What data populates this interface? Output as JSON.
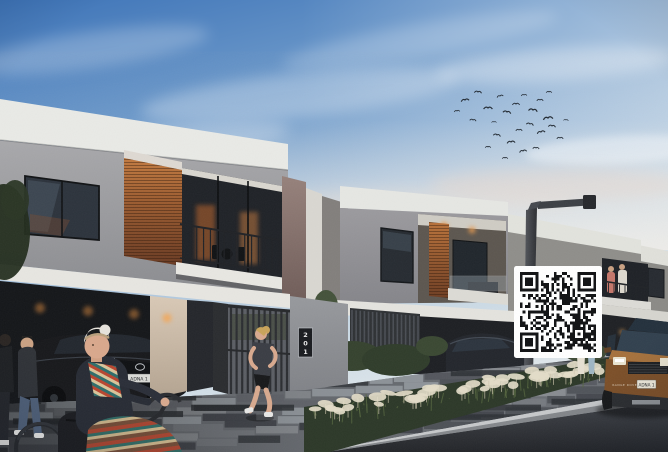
{
  "scene": {
    "kind": "dusk architectural rendering of modern two-storey townhouses",
    "house_number": "201",
    "lexus_plate": "ADNA 1",
    "suv_plate": "ADNA 1",
    "suv_hood_text": "RANGE ROVER"
  },
  "qr": {
    "modules": 29,
    "seed": 73512,
    "dark": "#101113",
    "light": "#ffffff",
    "x": 514,
    "y": 266,
    "w": 88,
    "h": 92,
    "quiet": 6
  },
  "birds": [
    [
      465,
      100,
      1.0,
      -10
    ],
    [
      478,
      92,
      0.9,
      5
    ],
    [
      488,
      108,
      1.1,
      0
    ],
    [
      500,
      96,
      0.8,
      -15
    ],
    [
      507,
      112,
      1.0,
      10
    ],
    [
      516,
      104,
      0.9,
      0
    ],
    [
      524,
      95,
      0.7,
      -5
    ],
    [
      533,
      110,
      1.1,
      8
    ],
    [
      540,
      100,
      0.8,
      0
    ],
    [
      548,
      118,
      1.2,
      -8
    ],
    [
      530,
      124,
      0.9,
      12
    ],
    [
      519,
      130,
      0.8,
      0
    ],
    [
      541,
      132,
      1.0,
      -12
    ],
    [
      552,
      126,
      0.9,
      6
    ],
    [
      560,
      138,
      0.8,
      0
    ],
    [
      511,
      142,
      1.0,
      -6
    ],
    [
      497,
      135,
      0.9,
      10
    ],
    [
      488,
      147,
      0.7,
      0
    ],
    [
      523,
      151,
      0.9,
      -10
    ],
    [
      536,
      148,
      0.8,
      4
    ],
    [
      505,
      158,
      0.7,
      0
    ],
    [
      473,
      120,
      0.8,
      8
    ],
    [
      457,
      111,
      0.7,
      -6
    ],
    [
      549,
      92,
      0.7,
      0
    ],
    [
      566,
      120,
      0.6,
      5
    ],
    [
      494,
      122,
      0.6,
      0
    ]
  ],
  "pavers": {
    "seed": 99,
    "rows": 8,
    "palette": [
      "#575b62",
      "#686c73",
      "#7a7e85",
      "#8d9197",
      "#50545b",
      "#3c4046",
      "#9aa0a6",
      "#44484f"
    ]
  },
  "plants": {
    "seed": 7,
    "tufts": 46,
    "blades": 70,
    "tuft_color": "#e3dcc8",
    "stem_color": "#cfc7ae",
    "blade_color": "#55663f"
  },
  "colors": {
    "sky_top": "#3e74b8",
    "sky_mid": "#9dbbd9",
    "sky_horizon": "#e3e9ec",
    "parapet_white": "#e9eae6",
    "stone_grey": "#9b9ba0",
    "wood_light": "#c27a40",
    "wood_dark": "#693a22",
    "garage_dark": "#141619",
    "road": "#2c2e33",
    "curb": "#c6c8ca",
    "suv_bronze": "#8e5c33",
    "qr_bg": "#ffffff"
  }
}
